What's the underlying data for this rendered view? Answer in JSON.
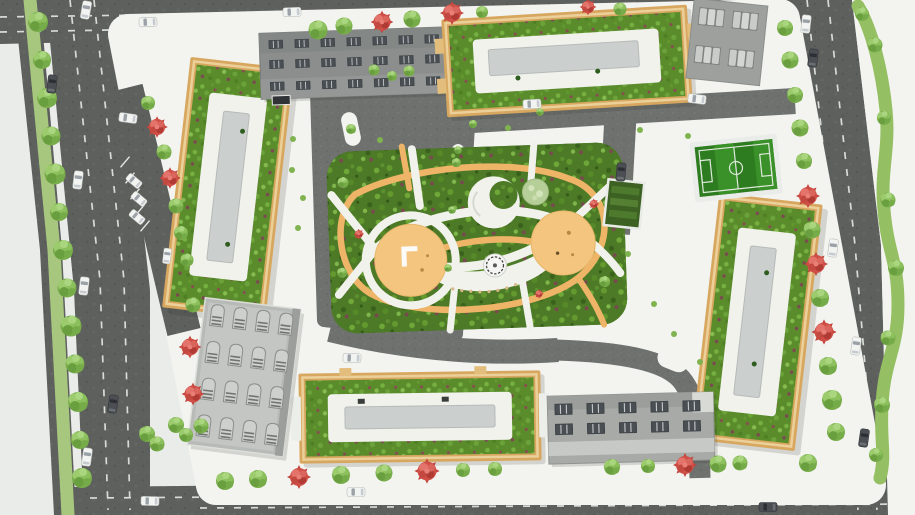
{
  "scene": {
    "type": "aerial-site-plan-render",
    "subject": "Top-down architectural master plan render of a residential complex: four green-roof apartment blocks around a central landscaped park, perimeter roads with tree lines, football pitch, parking areas and utility buildings",
    "view": "top-down",
    "visible_text": ""
  },
  "colors": {
    "bg": "#eaece9",
    "sidewalk": "#f3f4f0",
    "road": "#5d605d",
    "lane": "#d8dbd6",
    "drive": "#6e716e",
    "facade": "#d7a75f",
    "roofGreen": "#5a8c2c",
    "parkGreen": "#4d7a26",
    "paths": "#f1f2ec",
    "track": "#eeb468",
    "plaza": "#f3c57f",
    "grayBar": "#cbcfce",
    "grayBldg": "#8b8e8c",
    "lightGrayBldg": "#b7bab6",
    "pitchGreen": "#2e7c20",
    "pitchStripe": "#3b9129",
    "treeGreen": "#79ad4b",
    "treeRed": "#cf4e45",
    "carWhite": "#f2f4f2",
    "carDark": "#4b4f53"
  },
  "features": {
    "residential_blocks": [
      {
        "id": "west-block",
        "roof": "green roof garden with white deck and gray core"
      },
      {
        "id": "northeast-block",
        "roof": "green roof garden with white deck and gray core"
      },
      {
        "id": "east-block",
        "roof": "green roof garden with white deck and gray core"
      },
      {
        "id": "south-block",
        "roof": "green roof garden with white deck and gray core"
      }
    ],
    "utility_buildings": [
      {
        "id": "north-building",
        "style": "dark gray flat roof with rooftop window units"
      },
      {
        "id": "southwest-building",
        "style": "light gray roof with 4x4 skylight grid"
      },
      {
        "id": "southeast-building",
        "style": "gray flat roof with rooftop units"
      }
    ],
    "amenities": [
      "central-park",
      "running-track-loop",
      "playground-west",
      "playground-east",
      "amphitheater-plaza",
      "fountain",
      "tree-canopy-circle",
      "community-garden-plot",
      "football-pitch",
      "carport-parking-pad",
      "angled-street-parking"
    ],
    "roads": [
      "north-road",
      "west-boulevard-with-tree-median",
      "east-road-with-green-serpentine",
      "south-road",
      "internal-drives"
    ],
    "vegetation": {
      "green_trees": 60,
      "red_trees": 16,
      "west_tree_median": true,
      "east_serpentine_green": true
    }
  }
}
